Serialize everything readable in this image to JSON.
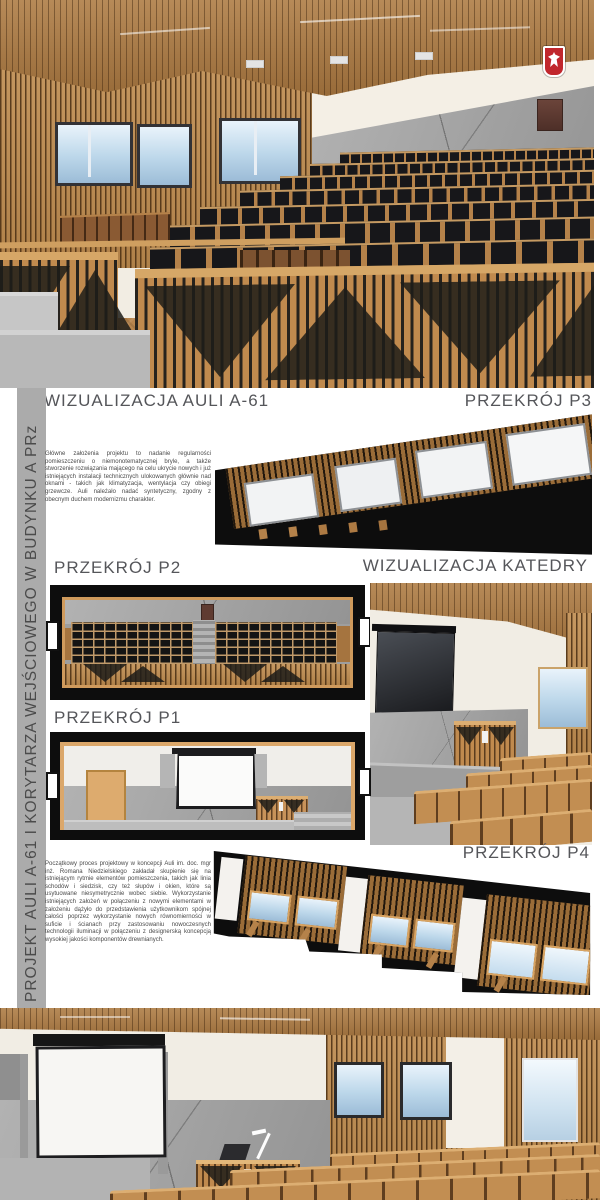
{
  "board": {
    "sidebar_title": "PROJEKT AULI A-61 I KORYTARZA WEJŚCIOWEGO W BUDYNKU A PRz",
    "headings": {
      "viz_auli": "WIZUALIZACJA AULI A-61",
      "p3": "PRZEKRÓJ P3",
      "p2": "PRZEKRÓJ P2",
      "viz_katedry": "WIZUALIZACJA KATEDRY",
      "p1": "PRZEKRÓJ P1",
      "p4": "PRZEKRÓJ P4"
    },
    "paragraphs": {
      "intro": "Główne założenia projektu to nadanie regularności pomieszczeniu o niemonotematycznej bryle, a także stworzenie rozwiązania mającego na celu ukrycie nowych i już istniejących instalacji technicznych ulokowanych głównie nad oknami - takich jak klimatyzacja, wentylacja czy obiegi grzewcze. Auli należało nadać syntetyczny, zgodny z obecnym duchem modernizmu charakter.",
      "process": "Początkowy proces projektowy w koncepcji Auli im. doc. mgr inż. Romana Niedzielskiego zakładał skupienie się na istniejącym rytmie elementów pomieszczenia, takich jak linia schodów i siedzisk, czy też słupów i okien, które są usytuowane niesymetrycznie wobec siebie. Wykorzystanie istniejących założeń w połączeniu z nowymi elementami w założeniu dążyło do przedstawienia użytkownikom spójnej całości poprzez wykorzystanie nowych równomierności w suficie i ścianach przy zastosowaniu nowoczesnych technologii iluminacji w połączeniu z designerską koncepcją wysokiej jakości komponentów drewnianych."
    },
    "icons": {
      "emblem": "polish-eagle-emblem"
    },
    "colors": {
      "heading": "#55565a",
      "body_text": "#4a4a4a",
      "sidebar_bar": "#ababab",
      "sidebar_text": "#4b4b4b",
      "wood": "#bf8c4f",
      "seat_black": "#17171a",
      "concrete": "#a5a5a5",
      "emblem_red": "#c1272d"
    }
  }
}
